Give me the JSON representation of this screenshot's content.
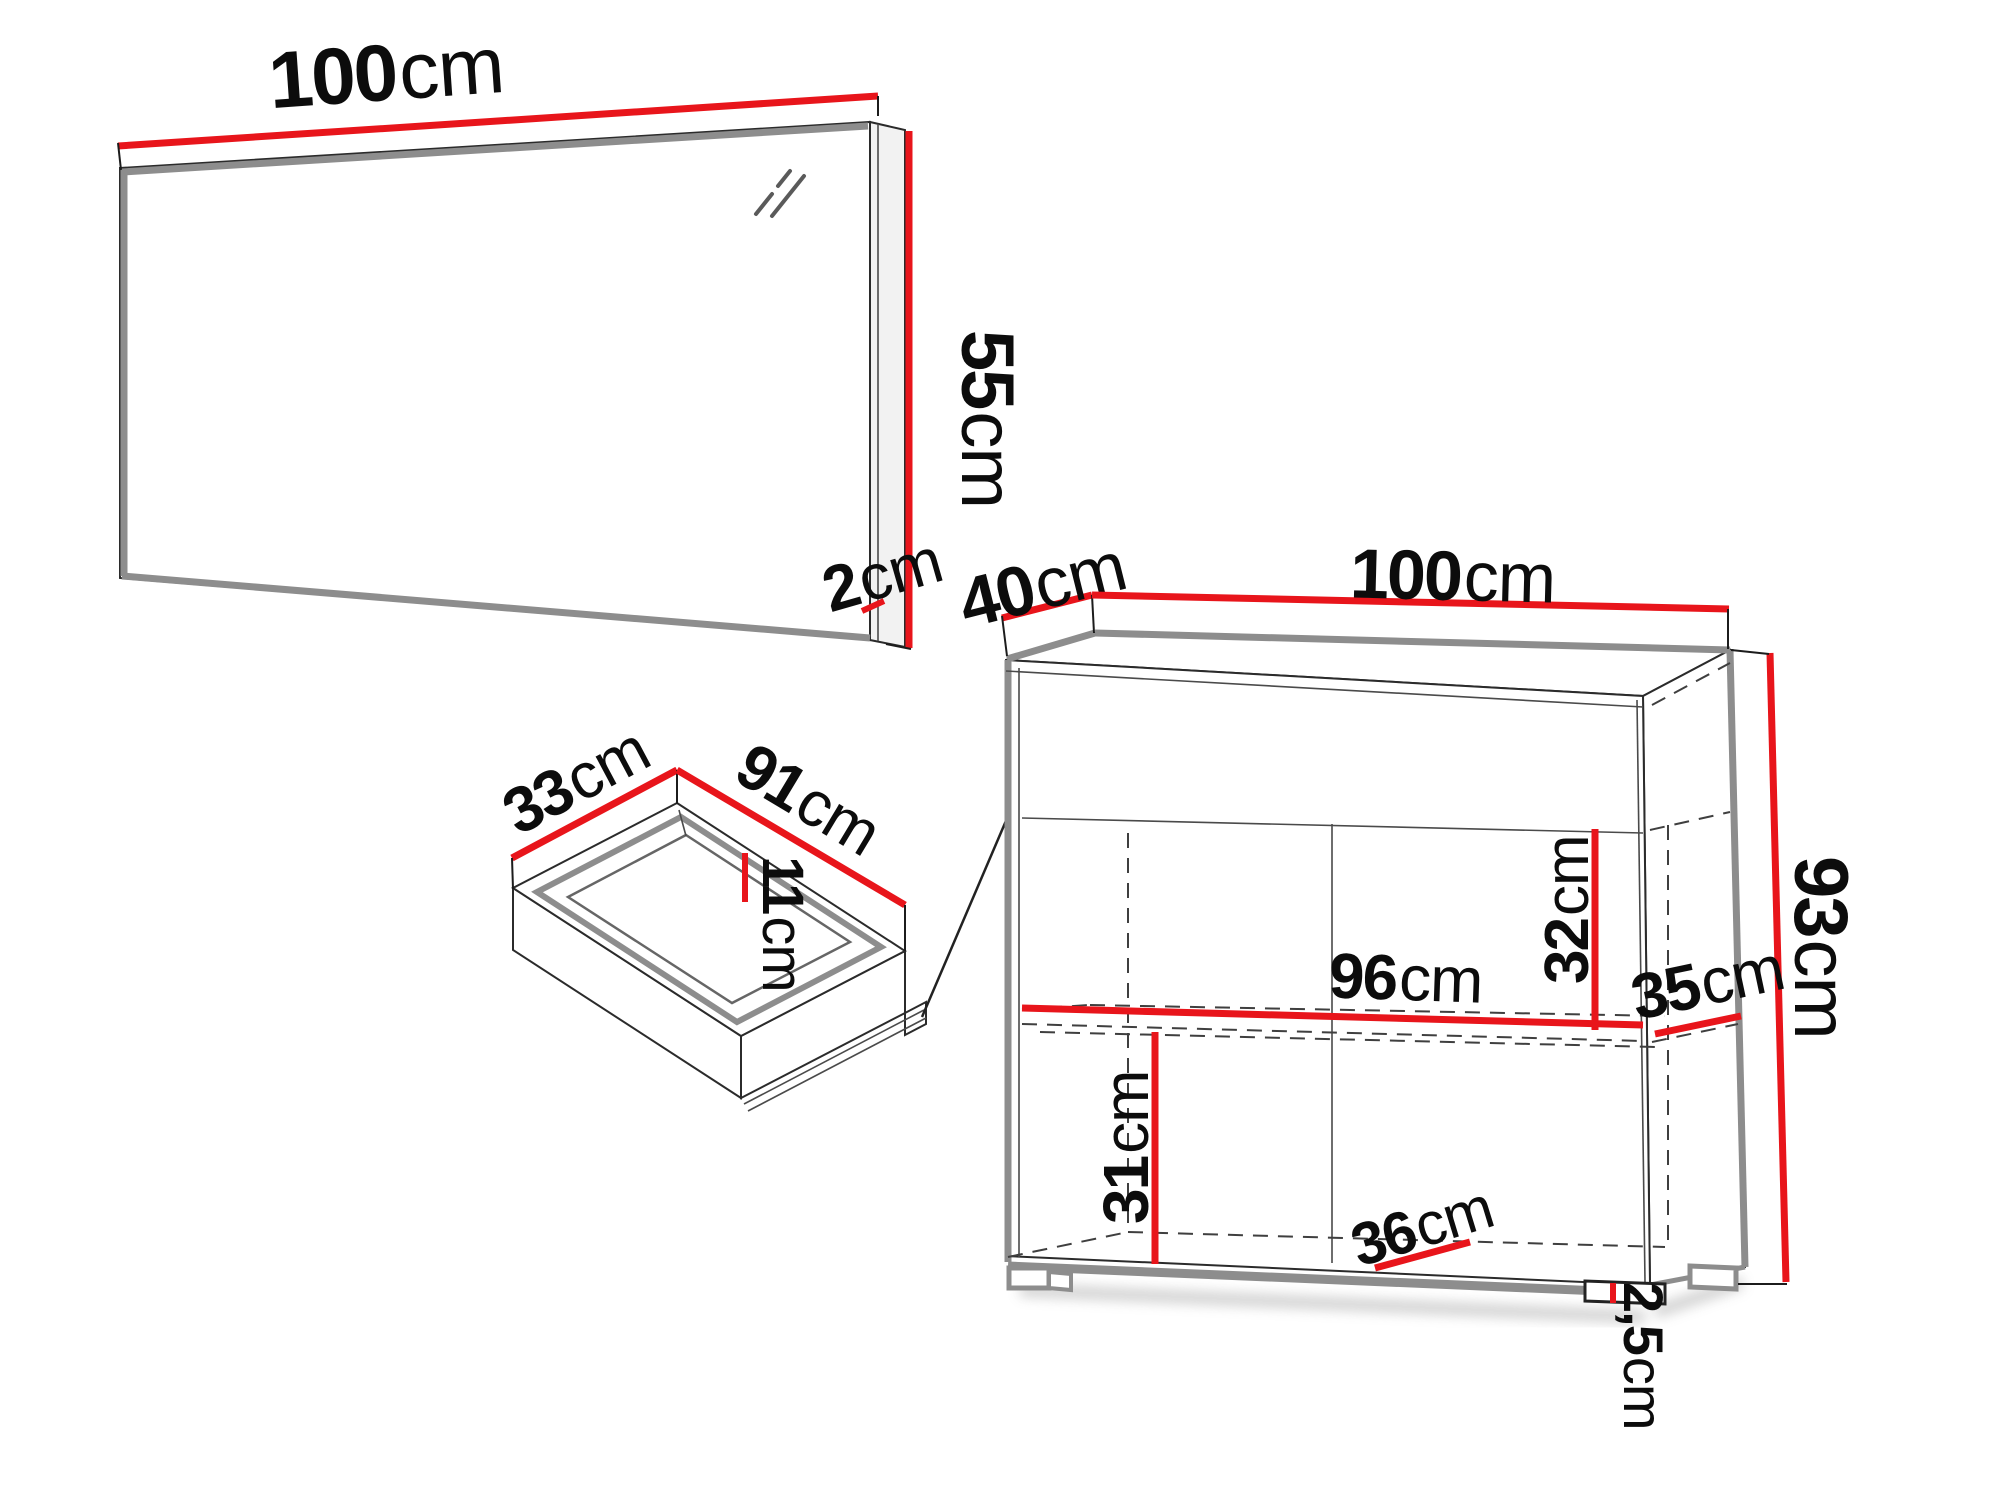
{
  "colors": {
    "accent": "#e8151b",
    "edge_gray": "#8d8d8d",
    "line_dark": "#2b2b2b",
    "background": "#ffffff"
  },
  "mirror": {
    "width": {
      "value": "100",
      "unit": "cm"
    },
    "height": {
      "value": "55",
      "unit": "cm"
    },
    "thickness": {
      "value": "2",
      "unit": "cm"
    }
  },
  "drawer": {
    "depth": {
      "value": "33",
      "unit": "cm"
    },
    "width": {
      "value": "91",
      "unit": "cm"
    },
    "height": {
      "value": "11",
      "unit": "cm"
    }
  },
  "cabinet": {
    "depth": {
      "value": "40",
      "unit": "cm"
    },
    "width": {
      "value": "100",
      "unit": "cm"
    },
    "height": {
      "value": "93",
      "unit": "cm"
    },
    "upper_inner_height": {
      "value": "32",
      "unit": "cm"
    },
    "inner_width": {
      "value": "96",
      "unit": "cm"
    },
    "inner_depth": {
      "value": "35",
      "unit": "cm"
    },
    "lower_inner_height": {
      "value": "31",
      "unit": "cm"
    },
    "lower_inner_width": {
      "value": "36",
      "unit": "cm"
    },
    "leg_height": {
      "value": "2,5",
      "unit": "cm"
    }
  }
}
